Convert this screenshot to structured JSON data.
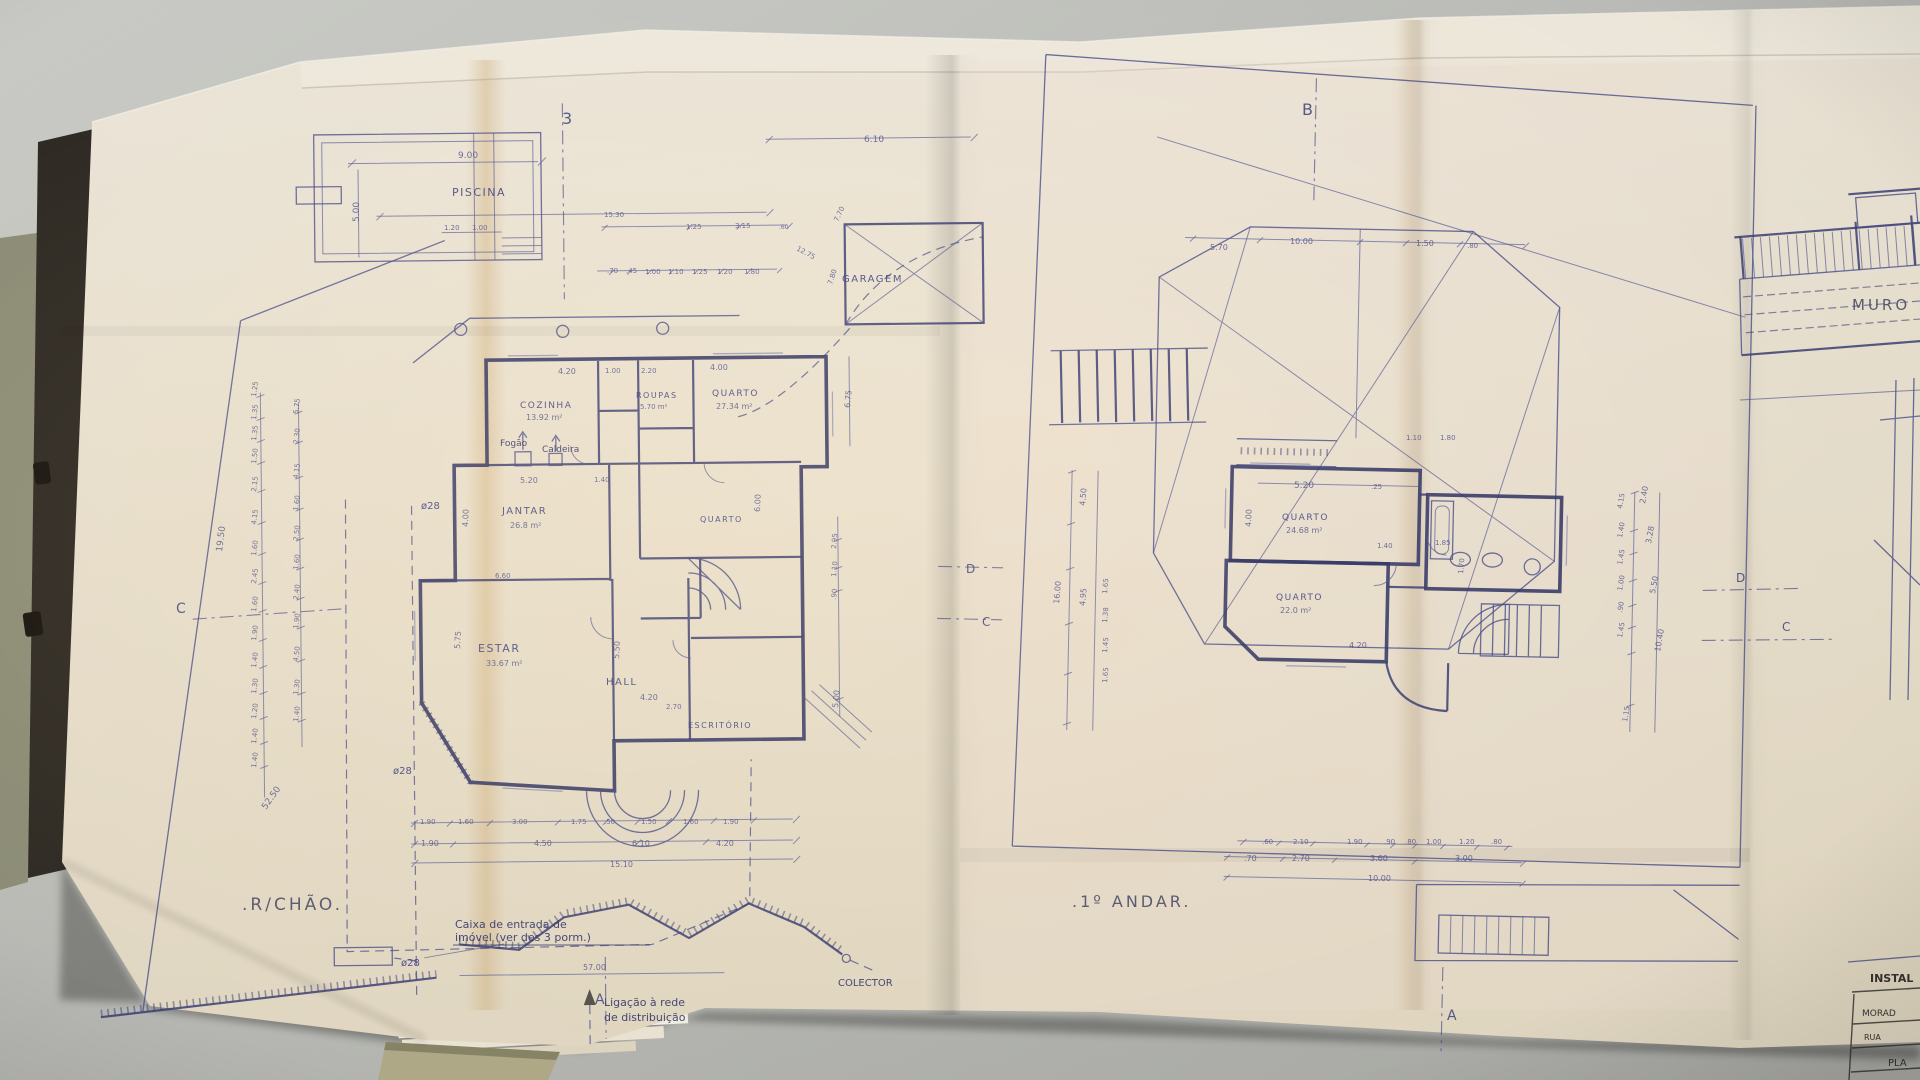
{
  "colors": {
    "ink": "#3d4284",
    "pencil": "#5f5b50",
    "paper": "#eee7d9",
    "desk": "#c0c1bc"
  },
  "sheet_left": {
    "title": ".R/CHÃO.",
    "pool_label": "PISCINA",
    "garage_label": "GARAGEM",
    "rooms": {
      "cozinha": "COZINHA",
      "cozinha_area": "13.92 m²",
      "jantar": "JANTAR",
      "jantar_area": "26.8 m²",
      "roupas": "ROUPAS",
      "roupas_area": "5.70 m²",
      "quarto": "QUARTO",
      "quarto_area": "27.34 m²",
      "quarto_mid": "QUARTO",
      "estar": "ESTAR",
      "estar_area": "33.67 m²",
      "hall": "HALL",
      "escritorio": "ESCRITÓRIO"
    },
    "equipment": {
      "fogao": "Fogão",
      "caldeira": "Caldeira"
    },
    "notes": {
      "caixa_1": "Caixa de entrada de",
      "caixa_2": "imóvel (ver des 3 porm.)",
      "ligacao_1": "Ligação à rede",
      "ligacao_2": "de distribuição",
      "colector": "COLECTOR"
    }
  },
  "sheet_right": {
    "title": ".1º ANDAR.",
    "rooms": {
      "quarto_1": "QUARTO",
      "quarto_1_area": "24.68 m²",
      "quarto_2": "QUARTO",
      "quarto_2_area": "22.0 m²"
    }
  },
  "sheet_edge": {
    "muro": "MURO",
    "titleblock": {
      "header": "INSTAL",
      "row_1": "MORAD",
      "row_2": "RUA",
      "row_3": "PLA"
    }
  },
  "annotations": [
    {
      "t": "3",
      "x": 562,
      "y": 124,
      "s": 16,
      "c": "marker"
    },
    {
      "t": "B",
      "x": 1302,
      "y": 115,
      "s": 16,
      "c": "marker"
    },
    {
      "t": "C",
      "x": 176,
      "y": 613,
      "s": 14,
      "c": "marker"
    },
    {
      "t": "D",
      "x": 966,
      "y": 573,
      "s": 12,
      "c": "marker"
    },
    {
      "t": "C",
      "x": 982,
      "y": 626,
      "s": 12,
      "c": "marker"
    },
    {
      "t": "D",
      "x": 1736,
      "y": 582,
      "s": 12,
      "c": "marker"
    },
    {
      "t": "C",
      "x": 1782,
      "y": 631,
      "s": 12,
      "c": "marker"
    },
    {
      "t": "A",
      "x": 595,
      "y": 1004,
      "s": 14,
      "c": "marker"
    },
    {
      "t": "A",
      "x": 1447,
      "y": 1020,
      "s": 14,
      "c": "marker"
    },
    {
      "t": "ø28",
      "x": 421,
      "y": 509,
      "s": 10,
      "c": "ink"
    },
    {
      "t": "ø28",
      "x": 393,
      "y": 774,
      "s": 10,
      "c": "ink"
    },
    {
      "t": "ø28",
      "x": 401,
      "y": 966,
      "s": 10,
      "c": "ink"
    },
    {
      "t": "9.00",
      "x": 458,
      "y": 158,
      "s": 9,
      "c": "dim"
    },
    {
      "t": "5.00",
      "x": 359,
      "y": 222,
      "r": -90,
      "s": 9,
      "c": "dim"
    },
    {
      "t": "1.20",
      "x": 444,
      "y": 230,
      "s": 7,
      "c": "dim"
    },
    {
      "t": "1.00",
      "x": 472,
      "y": 230,
      "s": 7,
      "c": "dim"
    },
    {
      "t": "15.30",
      "x": 604,
      "y": 217,
      "s": 7,
      "c": "dim"
    },
    {
      "t": "1.25",
      "x": 686,
      "y": 229,
      "s": 7,
      "c": "dim"
    },
    {
      "t": "3.15",
      "x": 735,
      "y": 228,
      "s": 7,
      "c": "dim"
    },
    {
      "t": ".60",
      "x": 779,
      "y": 229,
      "s": 6,
      "c": "dim"
    },
    {
      "t": "6.10",
      "x": 864,
      "y": 142,
      "s": 9,
      "c": "dim"
    },
    {
      "t": ".70",
      "x": 607,
      "y": 273,
      "s": 7,
      "c": "dim"
    },
    {
      "t": ".45",
      "x": 626,
      "y": 273,
      "s": 7,
      "c": "dim"
    },
    {
      "t": "1.00",
      "x": 645,
      "y": 274,
      "s": 7,
      "c": "dim"
    },
    {
      "t": "1.10",
      "x": 668,
      "y": 274,
      "s": 7,
      "c": "dim"
    },
    {
      "t": "1.25",
      "x": 692,
      "y": 274,
      "s": 7,
      "c": "dim"
    },
    {
      "t": "1.20",
      "x": 717,
      "y": 274,
      "s": 7,
      "c": "dim"
    },
    {
      "t": "1.80",
      "x": 744,
      "y": 274,
      "s": 7,
      "c": "dim"
    },
    {
      "t": "7.70",
      "x": 838,
      "y": 222,
      "r": -65,
      "s": 7,
      "c": "dim"
    },
    {
      "t": "12.75",
      "x": 796,
      "y": 250,
      "r": 28,
      "s": 7,
      "c": "dim"
    },
    {
      "t": "7.80",
      "x": 832,
      "y": 285,
      "r": -72,
      "s": 7,
      "c": "dim"
    },
    {
      "t": "1.25",
      "x": 256,
      "y": 397,
      "r": -83,
      "s": 7,
      "c": "dim"
    },
    {
      "t": "1.35",
      "x": 256,
      "y": 420,
      "r": -83,
      "s": 7,
      "c": "dim"
    },
    {
      "t": "1.35",
      "x": 256,
      "y": 441,
      "r": -83,
      "s": 7,
      "c": "dim"
    },
    {
      "t": "1.50",
      "x": 256,
      "y": 464,
      "r": -83,
      "s": 7,
      "c": "dim"
    },
    {
      "t": "2.15",
      "x": 256,
      "y": 492,
      "r": -83,
      "s": 7,
      "c": "dim"
    },
    {
      "t": "4.15",
      "x": 256,
      "y": 525,
      "r": -83,
      "s": 7,
      "c": "dim"
    },
    {
      "t": "1.60",
      "x": 256,
      "y": 556,
      "r": -83,
      "s": 7,
      "c": "dim"
    },
    {
      "t": "2.45",
      "x": 256,
      "y": 584,
      "r": -83,
      "s": 7,
      "c": "dim"
    },
    {
      "t": "1.60",
      "x": 256,
      "y": 612,
      "r": -83,
      "s": 7,
      "c": "dim"
    },
    {
      "t": "1.90",
      "x": 256,
      "y": 641,
      "r": -83,
      "s": 7,
      "c": "dim"
    },
    {
      "t": "1.40",
      "x": 256,
      "y": 668,
      "r": -83,
      "s": 7,
      "c": "dim"
    },
    {
      "t": "1.30",
      "x": 256,
      "y": 694,
      "r": -83,
      "s": 7,
      "c": "dim"
    },
    {
      "t": "1.20",
      "x": 256,
      "y": 719,
      "r": -83,
      "s": 7,
      "c": "dim"
    },
    {
      "t": "1.40",
      "x": 256,
      "y": 744,
      "r": -83,
      "s": 7,
      "c": "dim"
    },
    {
      "t": "1.40",
      "x": 256,
      "y": 768,
      "r": -83,
      "s": 7,
      "c": "dim"
    },
    {
      "t": "5.75",
      "x": 298,
      "y": 414,
      "r": -83,
      "s": 7,
      "c": "dim"
    },
    {
      "t": "2.30",
      "x": 298,
      "y": 444,
      "r": -83,
      "s": 7,
      "c": "dim"
    },
    {
      "t": "4.15",
      "x": 298,
      "y": 479,
      "r": -83,
      "s": 7,
      "c": "dim"
    },
    {
      "t": "1.60",
      "x": 298,
      "y": 511,
      "r": -83,
      "s": 7,
      "c": "dim"
    },
    {
      "t": "2.50",
      "x": 298,
      "y": 541,
      "r": -83,
      "s": 7,
      "c": "dim"
    },
    {
      "t": "1.60",
      "x": 298,
      "y": 570,
      "r": -83,
      "s": 7,
      "c": "dim"
    },
    {
      "t": "2.40",
      "x": 298,
      "y": 600,
      "r": -83,
      "s": 7,
      "c": "dim"
    },
    {
      "t": "1.90",
      "x": 298,
      "y": 629,
      "r": -83,
      "s": 7,
      "c": "dim"
    },
    {
      "t": "4.50",
      "x": 298,
      "y": 662,
      "r": -83,
      "s": 7,
      "c": "dim"
    },
    {
      "t": "1.30",
      "x": 298,
      "y": 695,
      "r": -83,
      "s": 7,
      "c": "dim"
    },
    {
      "t": "1.40",
      "x": 298,
      "y": 722,
      "r": -83,
      "s": 7,
      "c": "dim"
    },
    {
      "t": "19.50",
      "x": 222,
      "y": 552,
      "r": -83,
      "s": 9,
      "c": "dim"
    },
    {
      "t": "52.50",
      "x": 266,
      "y": 810,
      "r": -55,
      "s": 9,
      "c": "dim"
    },
    {
      "t": "4.20",
      "x": 558,
      "y": 374,
      "s": 8,
      "c": "dim"
    },
    {
      "t": "1.00",
      "x": 605,
      "y": 373,
      "s": 7,
      "c": "dim"
    },
    {
      "t": "2.20",
      "x": 641,
      "y": 373,
      "s": 7,
      "c": "dim"
    },
    {
      "t": "4.00",
      "x": 468,
      "y": 527,
      "r": -88,
      "s": 8,
      "c": "dim"
    },
    {
      "t": "5.20",
      "x": 520,
      "y": 483,
      "s": 8,
      "c": "dim"
    },
    {
      "t": "1.40",
      "x": 594,
      "y": 482,
      "s": 7,
      "c": "dim"
    },
    {
      "t": "6.60",
      "x": 495,
      "y": 578,
      "s": 7,
      "c": "dim"
    },
    {
      "t": "5.75",
      "x": 460,
      "y": 649,
      "r": -87,
      "s": 8,
      "c": "dim"
    },
    {
      "t": "5.50",
      "x": 619,
      "y": 659,
      "r": -87,
      "s": 8,
      "c": "dim"
    },
    {
      "t": "4.20",
      "x": 640,
      "y": 700,
      "s": 8,
      "c": "dim"
    },
    {
      "t": "2.70",
      "x": 666,
      "y": 709,
      "s": 7,
      "c": "dim"
    },
    {
      "t": "6.00",
      "x": 760,
      "y": 512,
      "r": -88,
      "s": 8,
      "c": "dim"
    },
    {
      "t": "4.00",
      "x": 710,
      "y": 370,
      "s": 8,
      "c": "dim"
    },
    {
      "t": "6.75",
      "x": 850,
      "y": 408,
      "r": -85,
      "s": 8,
      "c": "dim"
    },
    {
      "t": "2.95",
      "x": 836,
      "y": 549,
      "r": -85,
      "s": 7,
      "c": "dim"
    },
    {
      "t": "1.10",
      "x": 836,
      "y": 577,
      "r": -85,
      "s": 7,
      "c": "dim"
    },
    {
      "t": ".90",
      "x": 836,
      "y": 600,
      "r": -85,
      "s": 7,
      "c": "dim"
    },
    {
      "t": "5.00",
      "x": 838,
      "y": 708,
      "r": -85,
      "s": 8,
      "c": "dim"
    },
    {
      "t": "1.90",
      "x": 420,
      "y": 824,
      "s": 7,
      "c": "dim"
    },
    {
      "t": "1.60",
      "x": 458,
      "y": 824,
      "s": 7,
      "c": "dim"
    },
    {
      "t": "3.00",
      "x": 512,
      "y": 824,
      "s": 7,
      "c": "dim"
    },
    {
      "t": "1.75",
      "x": 571,
      "y": 824,
      "s": 7,
      "c": "dim"
    },
    {
      "t": ".50",
      "x": 604,
      "y": 824,
      "s": 7,
      "c": "dim"
    },
    {
      "t": "1.50",
      "x": 641,
      "y": 824,
      "s": 7,
      "c": "dim"
    },
    {
      "t": "1.60",
      "x": 683,
      "y": 824,
      "s": 7,
      "c": "dim"
    },
    {
      "t": "1.90",
      "x": 723,
      "y": 824,
      "s": 7,
      "c": "dim"
    },
    {
      "t": "1.90",
      "x": 421,
      "y": 846,
      "s": 8,
      "c": "dim"
    },
    {
      "t": "4.50",
      "x": 534,
      "y": 846,
      "s": 8,
      "c": "dim"
    },
    {
      "t": "6.10",
      "x": 632,
      "y": 846,
      "s": 8,
      "c": "dim"
    },
    {
      "t": "4.20",
      "x": 716,
      "y": 846,
      "s": 8,
      "c": "dim"
    },
    {
      "t": "15.10",
      "x": 610,
      "y": 867,
      "s": 8,
      "c": "dim"
    },
    {
      "t": "57.00",
      "x": 583,
      "y": 970,
      "s": 8,
      "c": "dim"
    },
    {
      "t": "5.70",
      "x": 1210,
      "y": 250,
      "s": 8,
      "c": "dim"
    },
    {
      "t": "10.00",
      "x": 1290,
      "y": 244,
      "s": 8,
      "c": "dim"
    },
    {
      "t": "1.50",
      "x": 1416,
      "y": 246,
      "s": 8,
      "c": "dim"
    },
    {
      "t": ".80",
      "x": 1467,
      "y": 248,
      "s": 7,
      "c": "dim"
    },
    {
      "t": "5.20",
      "x": 1294,
      "y": 488,
      "s": 9,
      "c": "dim"
    },
    {
      "t": ".25",
      "x": 1371,
      "y": 489,
      "s": 7,
      "c": "dim"
    },
    {
      "t": "4.00",
      "x": 1251,
      "y": 527,
      "r": -88,
      "s": 8,
      "c": "dim"
    },
    {
      "t": "1.40",
      "x": 1377,
      "y": 548,
      "s": 7,
      "c": "dim"
    },
    {
      "t": "1.85",
      "x": 1435,
      "y": 545,
      "s": 7,
      "c": "dim"
    },
    {
      "t": "1.10",
      "x": 1406,
      "y": 440,
      "s": 7,
      "c": "dim"
    },
    {
      "t": "1.80",
      "x": 1440,
      "y": 440,
      "s": 7,
      "c": "dim"
    },
    {
      "t": "4.20",
      "x": 1349,
      "y": 648,
      "s": 8,
      "c": "dim"
    },
    {
      "t": "1.70",
      "x": 1463,
      "y": 574,
      "r": -85,
      "s": 7,
      "c": "dim"
    },
    {
      "t": "16.00",
      "x": 1059,
      "y": 604,
      "r": -85,
      "s": 8,
      "c": "dim"
    },
    {
      "t": "4.50",
      "x": 1085,
      "y": 506,
      "r": -85,
      "s": 8,
      "c": "dim"
    },
    {
      "t": "4.95",
      "x": 1085,
      "y": 606,
      "r": -85,
      "s": 8,
      "c": "dim"
    },
    {
      "t": "1.65",
      "x": 1107,
      "y": 594,
      "r": -85,
      "s": 7,
      "c": "dim"
    },
    {
      "t": "1.38",
      "x": 1107,
      "y": 623,
      "r": -85,
      "s": 7,
      "c": "dim"
    },
    {
      "t": "1.45",
      "x": 1107,
      "y": 653,
      "r": -85,
      "s": 7,
      "c": "dim"
    },
    {
      "t": "1.65",
      "x": 1107,
      "y": 683,
      "r": -85,
      "s": 7,
      "c": "dim"
    },
    {
      "t": "2.40",
      "x": 1645,
      "y": 504,
      "r": -80,
      "s": 8,
      "c": "dim"
    },
    {
      "t": "3.28",
      "x": 1651,
      "y": 544,
      "r": -80,
      "s": 8,
      "c": "dim"
    },
    {
      "t": "5.50",
      "x": 1655,
      "y": 594,
      "r": -80,
      "s": 8,
      "c": "dim"
    },
    {
      "t": "10.40",
      "x": 1660,
      "y": 652,
      "r": -80,
      "s": 8,
      "c": "dim"
    },
    {
      "t": "4.15",
      "x": 1622,
      "y": 509,
      "r": -80,
      "s": 7,
      "c": "dim"
    },
    {
      "t": "1.40",
      "x": 1622,
      "y": 538,
      "r": -80,
      "s": 7,
      "c": "dim"
    },
    {
      "t": "1.45",
      "x": 1622,
      "y": 565,
      "r": -80,
      "s": 7,
      "c": "dim"
    },
    {
      "t": "1.00",
      "x": 1622,
      "y": 591,
      "r": -80,
      "s": 7,
      "c": "dim"
    },
    {
      "t": ".90",
      "x": 1622,
      "y": 613,
      "r": -80,
      "s": 7,
      "c": "dim"
    },
    {
      "t": "1.45",
      "x": 1622,
      "y": 638,
      "r": -80,
      "s": 7,
      "c": "dim"
    },
    {
      "t": "1.15",
      "x": 1627,
      "y": 722,
      "r": -80,
      "s": 7,
      "c": "dim"
    },
    {
      "t": ".60",
      "x": 1262,
      "y": 844,
      "s": 7,
      "c": "dim"
    },
    {
      "t": "2.10",
      "x": 1293,
      "y": 844,
      "s": 7,
      "c": "dim"
    },
    {
      "t": "1.90",
      "x": 1347,
      "y": 844,
      "s": 7,
      "c": "dim"
    },
    {
      "t": ".90",
      "x": 1384,
      "y": 844,
      "s": 7,
      "c": "dim"
    },
    {
      "t": ".80",
      "x": 1405,
      "y": 844,
      "s": 7,
      "c": "dim"
    },
    {
      "t": "1.00",
      "x": 1426,
      "y": 844,
      "s": 7,
      "c": "dim"
    },
    {
      "t": "1.20",
      "x": 1459,
      "y": 844,
      "s": 7,
      "c": "dim"
    },
    {
      "t": ".80",
      "x": 1491,
      "y": 844,
      "s": 7,
      "c": "dim"
    },
    {
      "t": ".70",
      "x": 1244,
      "y": 861,
      "s": 8,
      "c": "dim"
    },
    {
      "t": "2.70",
      "x": 1292,
      "y": 861,
      "s": 8,
      "c": "dim"
    },
    {
      "t": "3.60",
      "x": 1370,
      "y": 861,
      "s": 8,
      "c": "dim"
    },
    {
      "t": "3.00",
      "x": 1455,
      "y": 861,
      "s": 8,
      "c": "dim"
    },
    {
      "t": "10.00",
      "x": 1368,
      "y": 881,
      "s": 8,
      "c": "dim"
    }
  ]
}
